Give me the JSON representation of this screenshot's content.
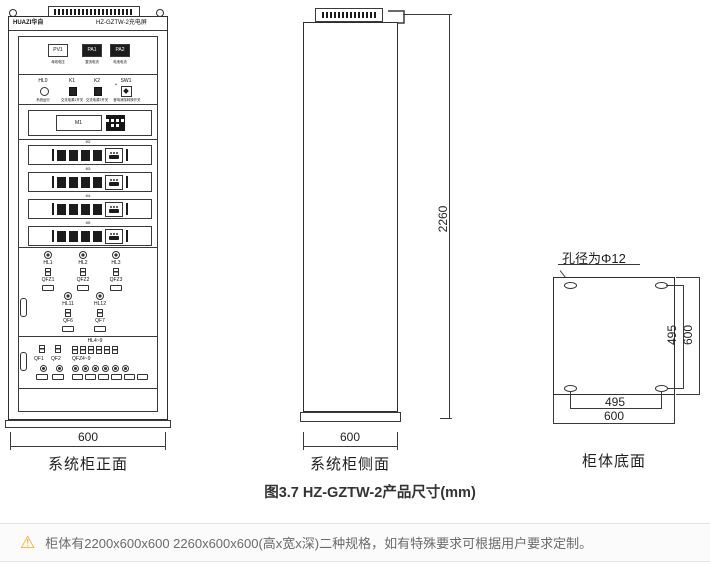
{
  "front": {
    "brand": "HUAZI华自",
    "model": "HZ-GZTW-2充电屏",
    "meters": {
      "m1": {
        "id": "PV1",
        "label": "母线电压"
      },
      "m2": {
        "id": "PA1",
        "label": "整流电流"
      },
      "m3": {
        "id": "PA2",
        "label": "电池电流"
      }
    },
    "controls": {
      "c1": {
        "id": "HL0",
        "label": "系统运行"
      },
      "c2": {
        "id": "K1",
        "label": "交流电源1开关"
      },
      "c3": {
        "id": "K2",
        "label": "交流电源2开关"
      },
      "c4": {
        "id": "SW1",
        "label": "音响消除转换开关"
      }
    },
    "monitor_label": "M1",
    "module_labels": [
      "M2",
      "M3",
      "M4",
      "M5"
    ],
    "breaker_cols": {
      "b1": {
        "lamp": "HL1",
        "breaker": "QFZ1"
      },
      "b2": {
        "lamp": "HL2",
        "breaker": "QFZ2"
      },
      "b3": {
        "lamp": "HL3",
        "breaker": "QFZ3"
      },
      "b4": {
        "lamp": "HL11",
        "breaker": "QF6"
      },
      "b5": {
        "lamp": "HL12",
        "breaker": "QF7"
      }
    },
    "bottom_group": {
      "qf1": "QF1",
      "qf2": "QF2",
      "hl_range": "HL4~9",
      "qfz_range": "QFZ4~9"
    },
    "width_dim": "600",
    "caption": "系统柜正面"
  },
  "side": {
    "height_dim": "2260",
    "width_dim": "600",
    "caption": "系统柜侧面"
  },
  "bottom": {
    "hole_note": "孔径为Φ12",
    "v_inner": "495",
    "v_outer": "600",
    "h_inner": "495",
    "h_outer": "600",
    "caption": "柜体底面"
  },
  "figure_caption": "图3.7 HZ-GZTW-2产品尺寸(mm)",
  "note": {
    "text": "柜体有2200x600x600 2260x600x600(高x宽x深)二种规格，如有特殊要求可根据用户要求定制。"
  },
  "colors": {
    "line": "#3a3a3a",
    "note_bg": "#fbfbfb",
    "warn": "#f5a623"
  }
}
